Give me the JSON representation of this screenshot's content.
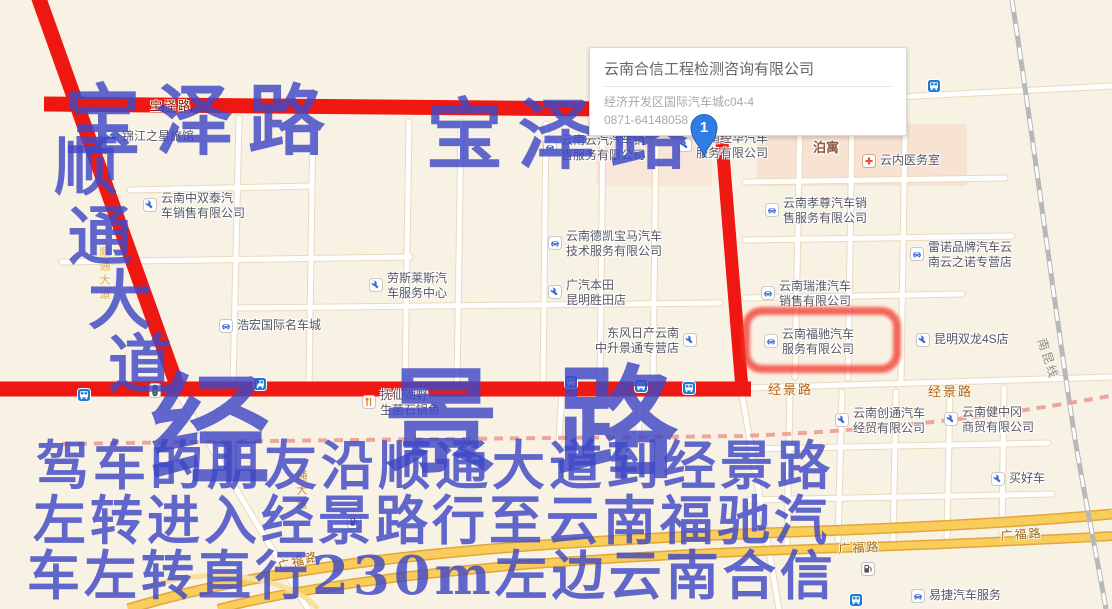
{
  "popup": {
    "title": "云南合信工程检测咨询有限公司",
    "address": "经济开发区国际汽车城c04-4",
    "phone": "0871-64148058"
  },
  "marker": {
    "label": "1"
  },
  "overlay": {
    "color": "#3f48c5",
    "baoze_left": "宝泽路",
    "baoze_right": "宝泽路",
    "shuntong": [
      "顺",
      "通",
      "大",
      "道"
    ],
    "jingjing": [
      "经",
      "景",
      "路"
    ],
    "directions": [
      "驾车的朋友沿顺通大道到经景路",
      "左转进入经景路行至云南福驰汽",
      "车左转直行230m左边云南合信"
    ]
  },
  "colors": {
    "route_red": "#ee0f0a",
    "highlight_red": "#f2372b",
    "marker_blue": "#2f7ce2",
    "overlay_blue": "#3f48c5"
  },
  "highlight": {
    "target": "云南福驰汽车服务有限公司"
  },
  "map": {
    "pois": [
      {
        "icon": "bed",
        "x": 104,
        "y": 130,
        "lines": [
          "锦江之星旅馆"
        ]
      },
      {
        "icon": "wrench",
        "x": 143,
        "y": 198,
        "lines": [
          "云南中双泰汽",
          "车销售有限公司"
        ]
      },
      {
        "icon": "car",
        "x": 543,
        "y": 140,
        "lines": [
          "云南云汽汽车销",
          "售服务有限公司"
        ]
      },
      {
        "icon": "wrench",
        "x": 678,
        "y": 138,
        "lines": [
          "云南经华汽车",
          "服务有限公司"
        ]
      },
      {
        "icon": "none",
        "x": 813,
        "y": 141,
        "lines": [
          "泊寓"
        ],
        "area": true
      },
      {
        "icon": "cross",
        "x": 862,
        "y": 154,
        "lines": [
          "云内医务室"
        ]
      },
      {
        "icon": "car",
        "x": 765,
        "y": 203,
        "lines": [
          "云南孝尊汽车销",
          "售服务有限公司"
        ]
      },
      {
        "icon": "car",
        "x": 548,
        "y": 236,
        "lines": [
          "云南德凯宝马汽车",
          "技术服务有限公司"
        ]
      },
      {
        "icon": "wrench",
        "x": 369,
        "y": 278,
        "lines": [
          "劳斯莱斯汽",
          "车服务中心"
        ]
      },
      {
        "icon": "wrench",
        "x": 548,
        "y": 285,
        "lines": [
          "广汽本田",
          "昆明胜田店"
        ]
      },
      {
        "icon": "car",
        "x": 910,
        "y": 247,
        "lines": [
          "雷诺品牌汽车云",
          "南云之诺专营店"
        ]
      },
      {
        "icon": "car",
        "x": 761,
        "y": 286,
        "lines": [
          "云南瑞淮汽车",
          "销售有限公司"
        ]
      },
      {
        "icon": "car",
        "x": 219,
        "y": 319,
        "lines": [
          "浩宏国际名车城"
        ]
      },
      {
        "icon": "wrench",
        "x": 683,
        "y": 333,
        "lines": [
          "东风日产云南",
          "中升景通专营店"
        ],
        "iconSide": "right"
      },
      {
        "icon": "car",
        "x": 764,
        "y": 334,
        "lines": [
          "云南福驰汽车",
          "服务有限公司"
        ]
      },
      {
        "icon": "wrench",
        "x": 916,
        "y": 333,
        "lines": [
          "昆明双龙4S店"
        ]
      },
      {
        "icon": "wrench",
        "x": 835,
        "y": 413,
        "lines": [
          "云南创通汽车",
          "经贸有限公司"
        ]
      },
      {
        "icon": "wrench",
        "x": 944,
        "y": 412,
        "lines": [
          "云南健中冈",
          "商贸有限公司"
        ]
      },
      {
        "icon": "wrench",
        "x": 991,
        "y": 472,
        "lines": [
          "买好车"
        ]
      },
      {
        "icon": "food",
        "x": 362,
        "y": 395,
        "lines": [
          "抚仙湖野",
          "生菌石锅鱼"
        ]
      },
      {
        "icon": "car",
        "x": 911,
        "y": 589,
        "lines": [
          "易捷汽车服务"
        ]
      }
    ],
    "road_labels": [
      {
        "text": "宝泽路",
        "x": 150,
        "y": 97,
        "color": "#7a2012",
        "size": 12
      },
      {
        "text": "经景路",
        "x": 768,
        "y": 379,
        "color": "#b5651d",
        "size": 13
      },
      {
        "text": "经景路",
        "x": 928,
        "y": 381,
        "color": "#b5651d",
        "size": 13
      },
      {
        "text": "广福路",
        "x": 838,
        "y": 540,
        "color": "#a06a1e",
        "size": 12,
        "rot": -3
      },
      {
        "text": "广福路",
        "x": 1000,
        "y": 527,
        "color": "#a06a1e",
        "size": 12,
        "rot": -4
      },
      {
        "text": "广福路",
        "x": 276,
        "y": 558,
        "color": "#a06a1e",
        "size": 12,
        "rot": -15
      },
      {
        "text": "南昆线",
        "x": 1050,
        "y": 336,
        "color": "#8c8c8c",
        "size": 12,
        "rot": 72
      },
      {
        "text": "通大道",
        "x": 293,
        "y": 470,
        "color": "#c08a3c",
        "size": 11,
        "vert": true
      },
      {
        "text": "顺通大道",
        "x": 96,
        "y": 246,
        "color": "#d8b04a",
        "size": 11,
        "vert": true
      }
    ],
    "transit": [
      {
        "type": "bus",
        "x": 77,
        "y": 388
      },
      {
        "type": "light",
        "x": 149,
        "y": 383
      },
      {
        "type": "bus",
        "x": 253,
        "y": 377
      },
      {
        "type": "bus",
        "x": 564,
        "y": 375
      },
      {
        "type": "bus",
        "x": 634,
        "y": 379
      },
      {
        "type": "bus",
        "x": 682,
        "y": 381
      },
      {
        "type": "bus",
        "x": 927,
        "y": 79
      },
      {
        "type": "bus",
        "x": 849,
        "y": 593
      },
      {
        "type": "gas",
        "x": 347,
        "y": 515
      },
      {
        "type": "gas",
        "x": 861,
        "y": 562
      }
    ]
  }
}
